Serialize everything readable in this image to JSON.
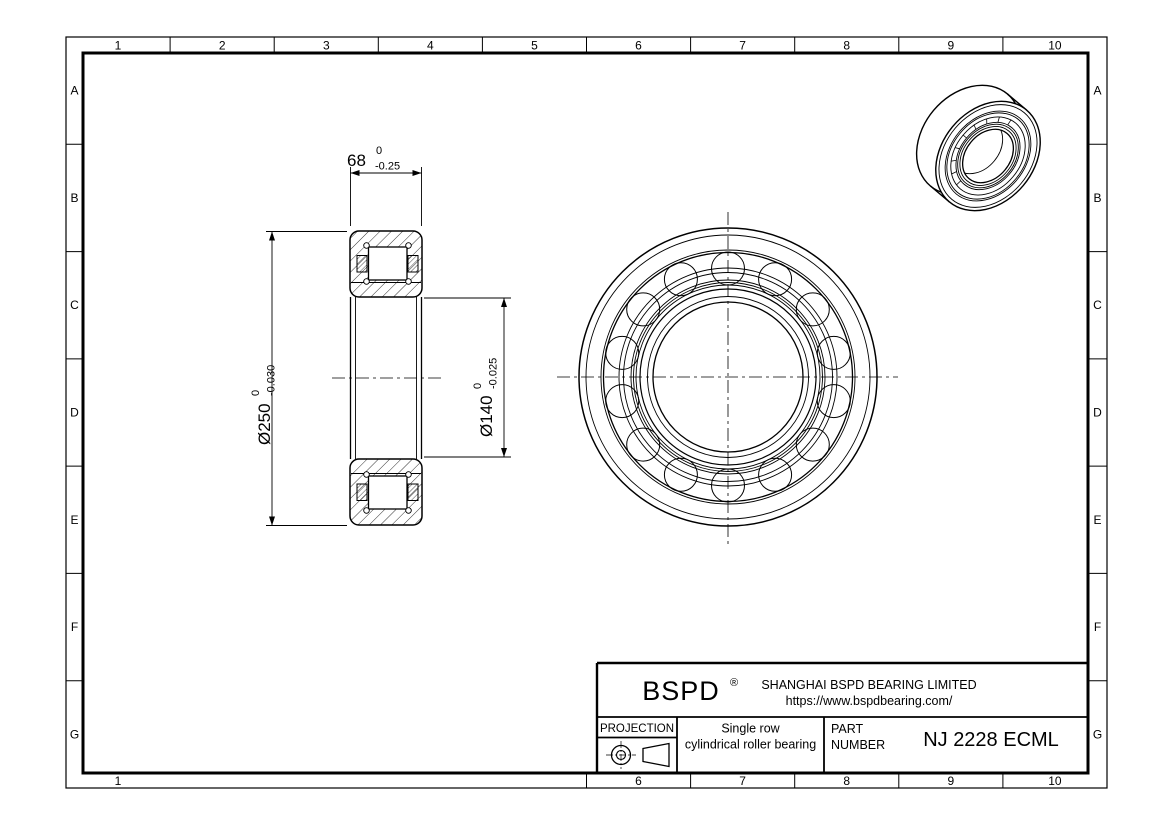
{
  "grid": {
    "top": [
      "1",
      "2",
      "3",
      "4",
      "5",
      "6",
      "7",
      "8",
      "9",
      "10"
    ],
    "bottom": [
      "1",
      "6",
      "7",
      "8",
      "9",
      "10"
    ],
    "left": [
      "A",
      "B",
      "C",
      "D",
      "E",
      "F",
      "G"
    ],
    "right": [
      "A",
      "B",
      "C",
      "D",
      "E",
      "F",
      "G"
    ]
  },
  "dimensions": {
    "width": {
      "value": "68",
      "upper": "0",
      "lower": "-0.25"
    },
    "outer_diameter": {
      "value": "Ø250",
      "upper": "0",
      "lower": "-0.030"
    },
    "bore_diameter": {
      "value": "Ø140",
      "upper": "0",
      "lower": "-0.025"
    }
  },
  "title_block": {
    "brand": "BSPD",
    "registered_mark": "®",
    "company": "SHANGHAI BSPD BEARING LIMITED",
    "website": "https://www.bspdbearing.com/",
    "projection_label": "PROJECTION",
    "product_line1": "Single row",
    "product_line2": "cylindrical roller bearing",
    "part_label_line1": "PART",
    "part_label_line2": "NUMBER",
    "part_number": "NJ 2228 ECML"
  },
  "colors": {
    "line": "#000000",
    "background": "#ffffff"
  }
}
